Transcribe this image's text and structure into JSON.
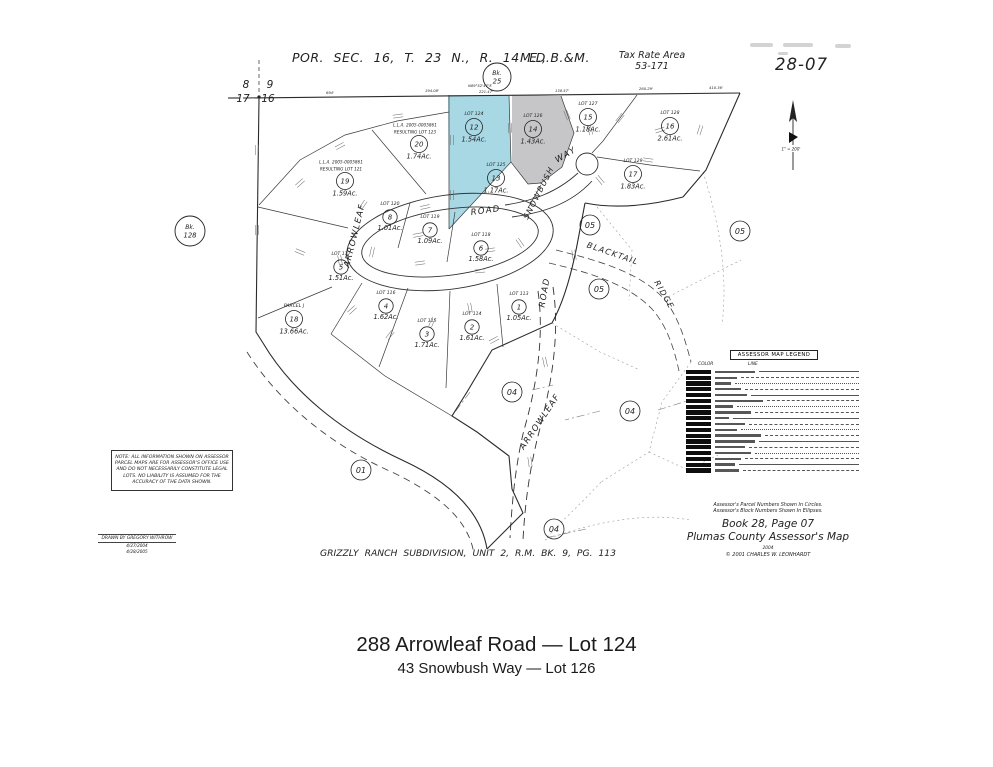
{
  "header": {
    "section_title": "POR. SEC. 16, T. 23 N., R. 14 E.,",
    "meridian": "M.D.B.&M.",
    "tax_rate_area_line1": "Tax Rate Area",
    "tax_rate_area_line2": "53-171",
    "page_number": "28-07"
  },
  "map": {
    "scale_label": "1\" = 200'",
    "corner": {
      "nw": "8",
      "ne": "9",
      "sw": "17",
      "se": "16"
    },
    "book_circles": [
      {
        "label": "Bk.",
        "number": "25",
        "x": 497,
        "y": 77,
        "r": 14
      },
      {
        "label": "Bk.",
        "number": "128",
        "x": 190,
        "y": 231,
        "r": 15
      }
    ],
    "colors": {
      "lot124_fill": "#a9d8e5",
      "lot126_fill": "#c6c6c8",
      "line": "#2e2e2e"
    },
    "lots": [
      {
        "lot": "LOT 124",
        "num": "12",
        "acres": "1.54Ac.",
        "x": 474,
        "y": 127,
        "fill": "#a9d8e5"
      },
      {
        "lot": "LOT 126",
        "num": "14",
        "acres": "1.43Ac.",
        "x": 533,
        "y": 129,
        "fill": "#c6c6c8"
      },
      {
        "lot": "LOT 125",
        "num": "13",
        "acres": "1.17Ac.",
        "x": 496,
        "y": 178
      },
      {
        "lot": "LOT 127",
        "num": "15",
        "acres": "1.18Ac.",
        "x": 588,
        "y": 117
      },
      {
        "lot": "LOT 128",
        "num": "16",
        "acres": "2.61Ac.",
        "x": 670,
        "y": 126
      },
      {
        "lot": "LOT 129",
        "num": "17",
        "acres": "1.83Ac.",
        "x": 633,
        "y": 174
      },
      {
        "lot": "LOT 123",
        "num": "20",
        "acres": "1.74Ac.",
        "x": 419,
        "y": 144,
        "lla": [
          "L.L.A. 2005-0005861",
          "RESULTING LOT 123"
        ]
      },
      {
        "lot": "LOT 121",
        "num": "19",
        "acres": "1.59Ac.",
        "x": 345,
        "y": 181,
        "lla": [
          "L.L.A. 2005-0005861",
          "RESULTING LOT 121"
        ]
      },
      {
        "lot": "LOT 120",
        "num": "8",
        "acres": "1.01Ac.",
        "x": 390,
        "y": 217
      },
      {
        "lot": "LOT 119",
        "num": "7",
        "acres": "1.09Ac.",
        "x": 430,
        "y": 230
      },
      {
        "lot": "LOT 118",
        "num": "6",
        "acres": "1.58Ac.",
        "x": 481,
        "y": 248
      },
      {
        "lot": "LOT 117",
        "num": "5",
        "acres": "1.51Ac.",
        "x": 341,
        "y": 267
      },
      {
        "lot": "LOT 116",
        "num": "4",
        "acres": "1.62Ac.",
        "x": 386,
        "y": 306
      },
      {
        "lot": "LOT 115",
        "num": "3",
        "acres": "1.71Ac.",
        "x": 427,
        "y": 334
      },
      {
        "lot": "LOT 114",
        "num": "2",
        "acres": "1.61Ac.",
        "x": 472,
        "y": 327
      },
      {
        "lot": "LOT 113",
        "num": "1",
        "acres": "1.05Ac.",
        "x": 519,
        "y": 307
      },
      {
        "lot": "PARCEL J",
        "num": "18",
        "acres": "13.66Ac.",
        "x": 294,
        "y": 319
      }
    ],
    "blocks": [
      {
        "label": "05",
        "x": 590,
        "y": 225
      },
      {
        "label": "05",
        "x": 740,
        "y": 231
      },
      {
        "label": "05",
        "x": 599,
        "y": 289
      },
      {
        "label": "04",
        "x": 512,
        "y": 392
      },
      {
        "label": "04",
        "x": 630,
        "y": 411
      },
      {
        "label": "04",
        "x": 554,
        "y": 529
      },
      {
        "label": "01",
        "x": 361,
        "y": 470
      }
    ],
    "roads": [
      {
        "label": "ARROWLEAF",
        "x": 357,
        "y": 236,
        "rotate": -76,
        "size": 8.5
      },
      {
        "label": "ROAD",
        "x": 486,
        "y": 213,
        "rotate": -8,
        "size": 8.5
      },
      {
        "label": "SNOWBUSH",
        "x": 541,
        "y": 194,
        "rotate": -63,
        "size": 8
      },
      {
        "label": "WAY",
        "x": 567,
        "y": 157,
        "rotate": -30,
        "size": 8.5
      },
      {
        "label": "BLACKTAIL",
        "x": 612,
        "y": 256,
        "rotate": 19,
        "size": 8
      },
      {
        "label": "RIDGE",
        "x": 662,
        "y": 296,
        "rotate": 60,
        "size": 8
      },
      {
        "label": "ROAD",
        "x": 547,
        "y": 293,
        "rotate": -80,
        "size": 8.5
      },
      {
        "label": "ARROWLEAF",
        "x": 542,
        "y": 423,
        "rotate": -56,
        "size": 8.5
      }
    ],
    "distance_labels": [
      {
        "t": "694'",
        "x": 330,
        "y": 94
      },
      {
        "t": "194.08'",
        "x": 432,
        "y": 92
      },
      {
        "t": "N89°52'47\"E",
        "x": 480,
        "y": 87
      },
      {
        "t": "221.47'",
        "x": 486,
        "y": 93
      },
      {
        "t": "138.57'",
        "x": 562,
        "y": 92
      },
      {
        "t": "260.29'",
        "x": 646,
        "y": 90
      },
      {
        "t": "410.36'",
        "x": 716,
        "y": 89
      }
    ]
  },
  "legend": {
    "title": "ASSESSOR MAP LEGEND",
    "col_color": "COLOR",
    "col_line": "LINE",
    "row_count": 18
  },
  "note_box": {
    "text": "NOTE: ALL INFORMATION SHOWN ON ASSESSOR\nPARCEL MAPS ARE FOR ASSESSOR'S OFFICE USE\nAND DO NOT NECESSARILY CONSTITUTE LEGAL\nLOTS. NO LIABILITY IS ASSUMED FOR THE\nACCURACY OF THE DATA SHOWN."
  },
  "drawn_by": {
    "line": "DRAWN BY GREGORY WITHROW",
    "date1": "4/27/2004",
    "date2": "4/28/2005"
  },
  "footer": {
    "note1": "Assessor's Parcel Numbers Shown In Circles.",
    "note2": "Assessor's Block Numbers Shown In Ellipses.",
    "book_page": "Book 28, Page 07",
    "map_name": "Plumas County Assessor's Map",
    "year": "2004",
    "copyright": "© 2001 CHARLES W. LEONHARDT",
    "subdivision": "GRIZZLY RANCH SUBDIVISION, UNIT 2, R.M. BK. 9, PG. 113"
  },
  "caption": {
    "line1": "288 Arrowleaf Road — Lot 124",
    "line2": "43 Snowbush Way — Lot 126"
  }
}
